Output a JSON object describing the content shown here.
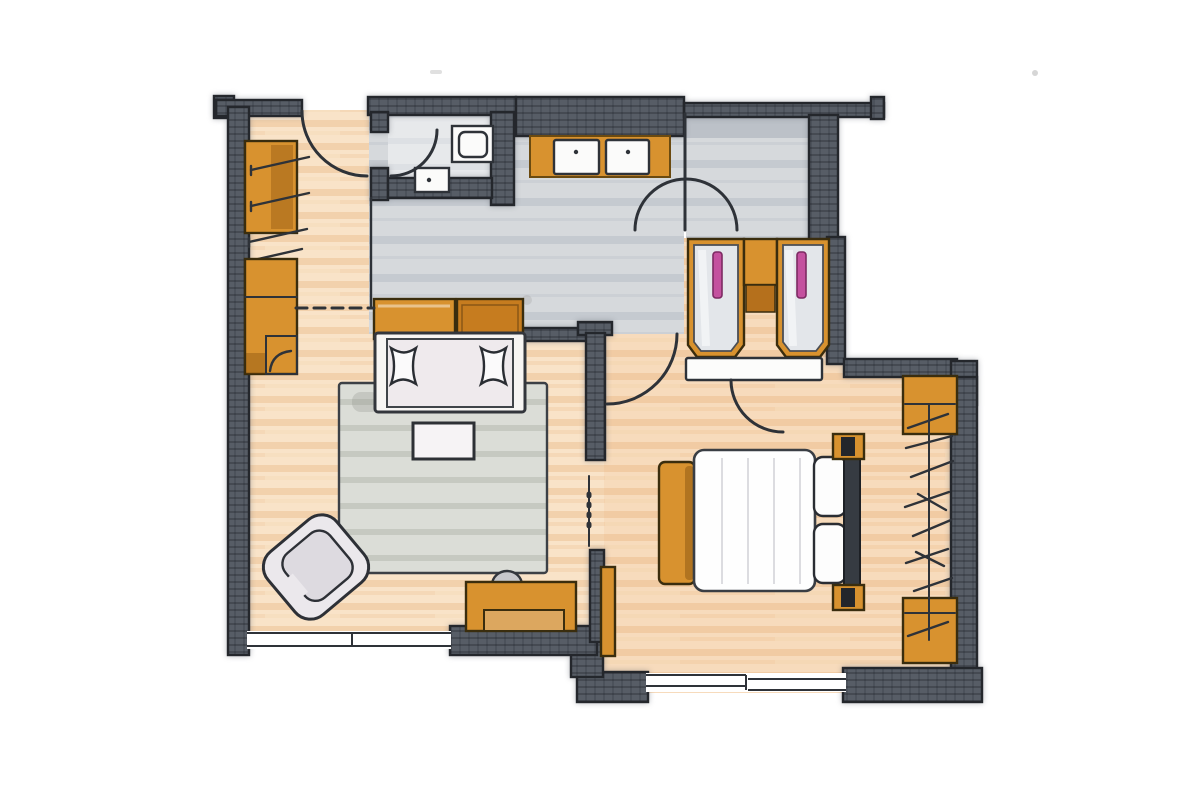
{
  "document": {
    "title": "Hand-drawn apartment floor plan",
    "medium": "marker and ink sketch, scanned on white background",
    "visible_text": "none"
  },
  "palette": {
    "background": "#ffffff",
    "wall_fill": "#575d66",
    "wall_line": "#24272c",
    "ink_line": "#2e3238",
    "wood_floor": "#f9e3c8",
    "wood_streak": "#f0cba2",
    "bedroom_tint": "rgba(238,160,88,0.10)",
    "tile_floor": "#d6d9dc",
    "tile_stripe": "#c5cad0",
    "wc_floor": "#e7e9eb",
    "bulkhead_gray": "#bcc1c8",
    "furniture_orange": "#d8922f",
    "furniture_orange_deep": "#c67c1f",
    "drawer_tan": "#dca75f",
    "fixture_white": "#fbfbfa",
    "mattress_white": "#efeaed",
    "handle_pink": "#c4519f",
    "handle_pink_edge": "#7d2a63",
    "rug_gray": "#dbddd7",
    "cushion_gray": "#ebe8ec",
    "headboard_dark": "#363b42",
    "chair_gray": "#c7c7cb",
    "wardrobe_front": "#e3e6ea"
  },
  "rooms": [
    {
      "id": "living-room",
      "label": "living / lounge room",
      "floor": "wood",
      "position": "left"
    },
    {
      "id": "bedroom",
      "label": "bedroom",
      "floor": "wood",
      "position": "right"
    },
    {
      "id": "wc",
      "label": "WC",
      "floor": "tile",
      "position": "top-left"
    },
    {
      "id": "hall",
      "label": "entrance hall with vanity",
      "floor": "tile",
      "position": "top-center"
    }
  ],
  "fixtures": [
    {
      "id": "toilet",
      "room": "wc"
    },
    {
      "id": "hand-basin",
      "room": "wc"
    },
    {
      "id": "vanity-counter",
      "room": "hall",
      "sinks": 2
    }
  ],
  "furniture": [
    {
      "id": "hanging-rail-wardrobe",
      "room": "living-room",
      "color": "orange",
      "hangers": 4
    },
    {
      "id": "dresser",
      "room": "living-room",
      "color": "orange"
    },
    {
      "id": "sideboard",
      "room": "living-room",
      "color": "orange",
      "sections": 2
    },
    {
      "id": "daybed",
      "room": "living-room",
      "cushions": 2
    },
    {
      "id": "rug",
      "room": "living-room",
      "color": "gray"
    },
    {
      "id": "coffee-table",
      "room": "living-room",
      "color": "white"
    },
    {
      "id": "armchair",
      "room": "living-room",
      "rotated": true
    },
    {
      "id": "desk",
      "room": "living-room",
      "color": "orange"
    },
    {
      "id": "desk-chair",
      "room": "living-room",
      "color": "gray"
    },
    {
      "id": "tall-wardrobe-left",
      "room": "hall",
      "handle": "pink"
    },
    {
      "id": "tall-wardrobe-right",
      "room": "hall",
      "handle": "pink"
    },
    {
      "id": "shelf-niche",
      "room": "hall",
      "color": "orange"
    },
    {
      "id": "threshold-band",
      "room": "bedroom",
      "color": "white"
    },
    {
      "id": "double-bed",
      "room": "bedroom",
      "pillows": 2,
      "parts": [
        "duvet",
        "headboard",
        "bedposts",
        "foot-bench"
      ]
    },
    {
      "id": "open-wardrobe",
      "room": "bedroom",
      "parts": [
        "top-cabinet",
        "hanging-rail",
        "bottom-cabinet"
      ],
      "hangers": 8
    },
    {
      "id": "side-cabinet",
      "room": "bedroom",
      "color": "orange"
    }
  ],
  "doors": [
    {
      "id": "entry-door",
      "wall": "top-left",
      "swing": "quarter-arc"
    },
    {
      "id": "wc-door",
      "wall": "wc-left",
      "swing": "quarter-arc"
    },
    {
      "id": "hall-door",
      "wall": "hall-center",
      "swing": "half-arc"
    },
    {
      "id": "living-room-door",
      "wall": "hall-south",
      "swing": "quarter-arc"
    },
    {
      "id": "bedroom-door",
      "wall": "bedroom-north",
      "swing": "quarter-arc"
    }
  ],
  "windows": [
    {
      "id": "living-window",
      "wall": "south",
      "segments": 1
    },
    {
      "id": "bedroom-window",
      "wall": "south",
      "segments": 2
    }
  ]
}
